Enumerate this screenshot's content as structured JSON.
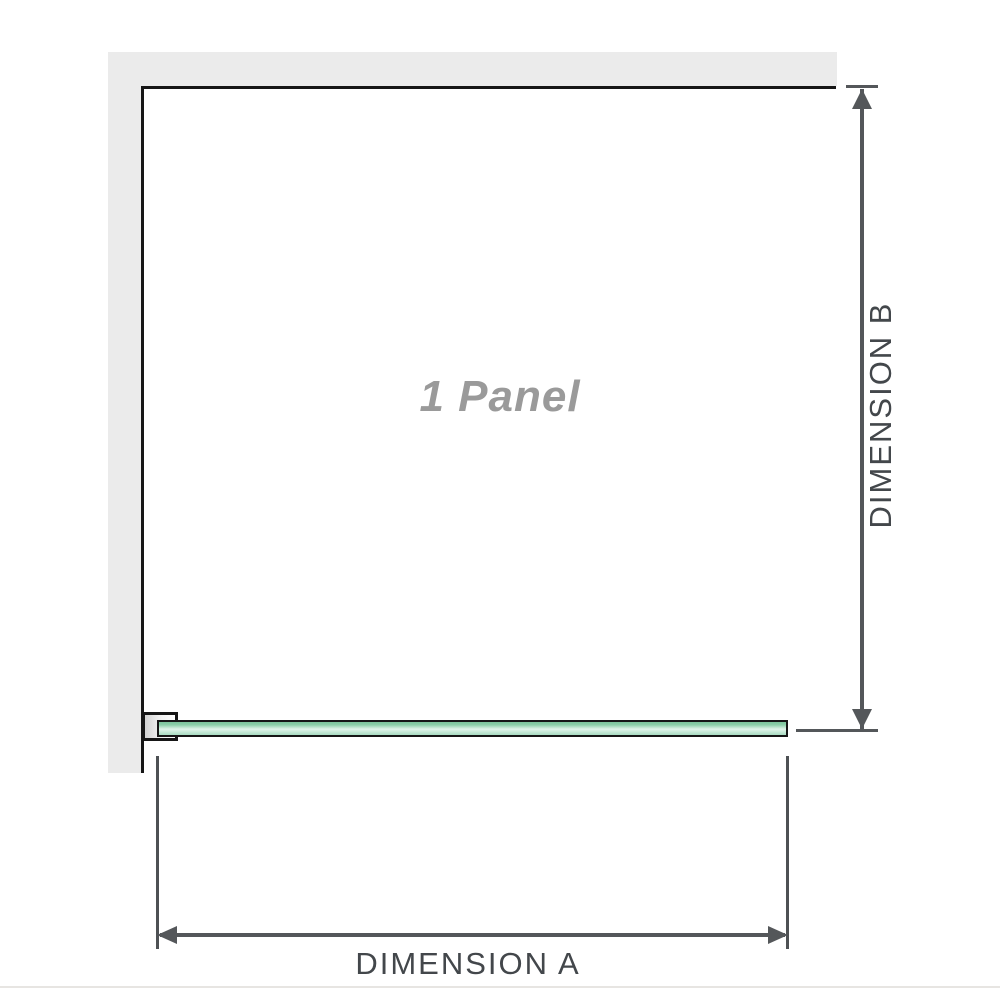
{
  "diagram": {
    "title": "Shower screen 1 panel configuration diagram",
    "panel_label": "1 Panel",
    "dimension_a": {
      "label": "DIMENSION A",
      "orientation": "horizontal",
      "measures": "glass panel width"
    },
    "dimension_b": {
      "label": "DIMENSION B",
      "orientation": "vertical",
      "measures": "enclosure depth from wall to glass panel"
    },
    "elements": {
      "wall": "L-shaped wall (top and left)",
      "bracket": "wall-mount clamp holding glass panel",
      "glass_panel": "glass panel shown edge-on in plan view"
    },
    "colors": {
      "wall_fill": "#ebebeb",
      "outline": "#161616",
      "dimension_lines": "#54575a",
      "dimension_text": "#43474b",
      "panel_label_text": "#9a9a9a",
      "glass_green_dark": "#7cc49b",
      "glass_green_light": "#e2f5ea",
      "glass_green_mid": "#a8dcc1",
      "background": "#ffffff"
    }
  }
}
